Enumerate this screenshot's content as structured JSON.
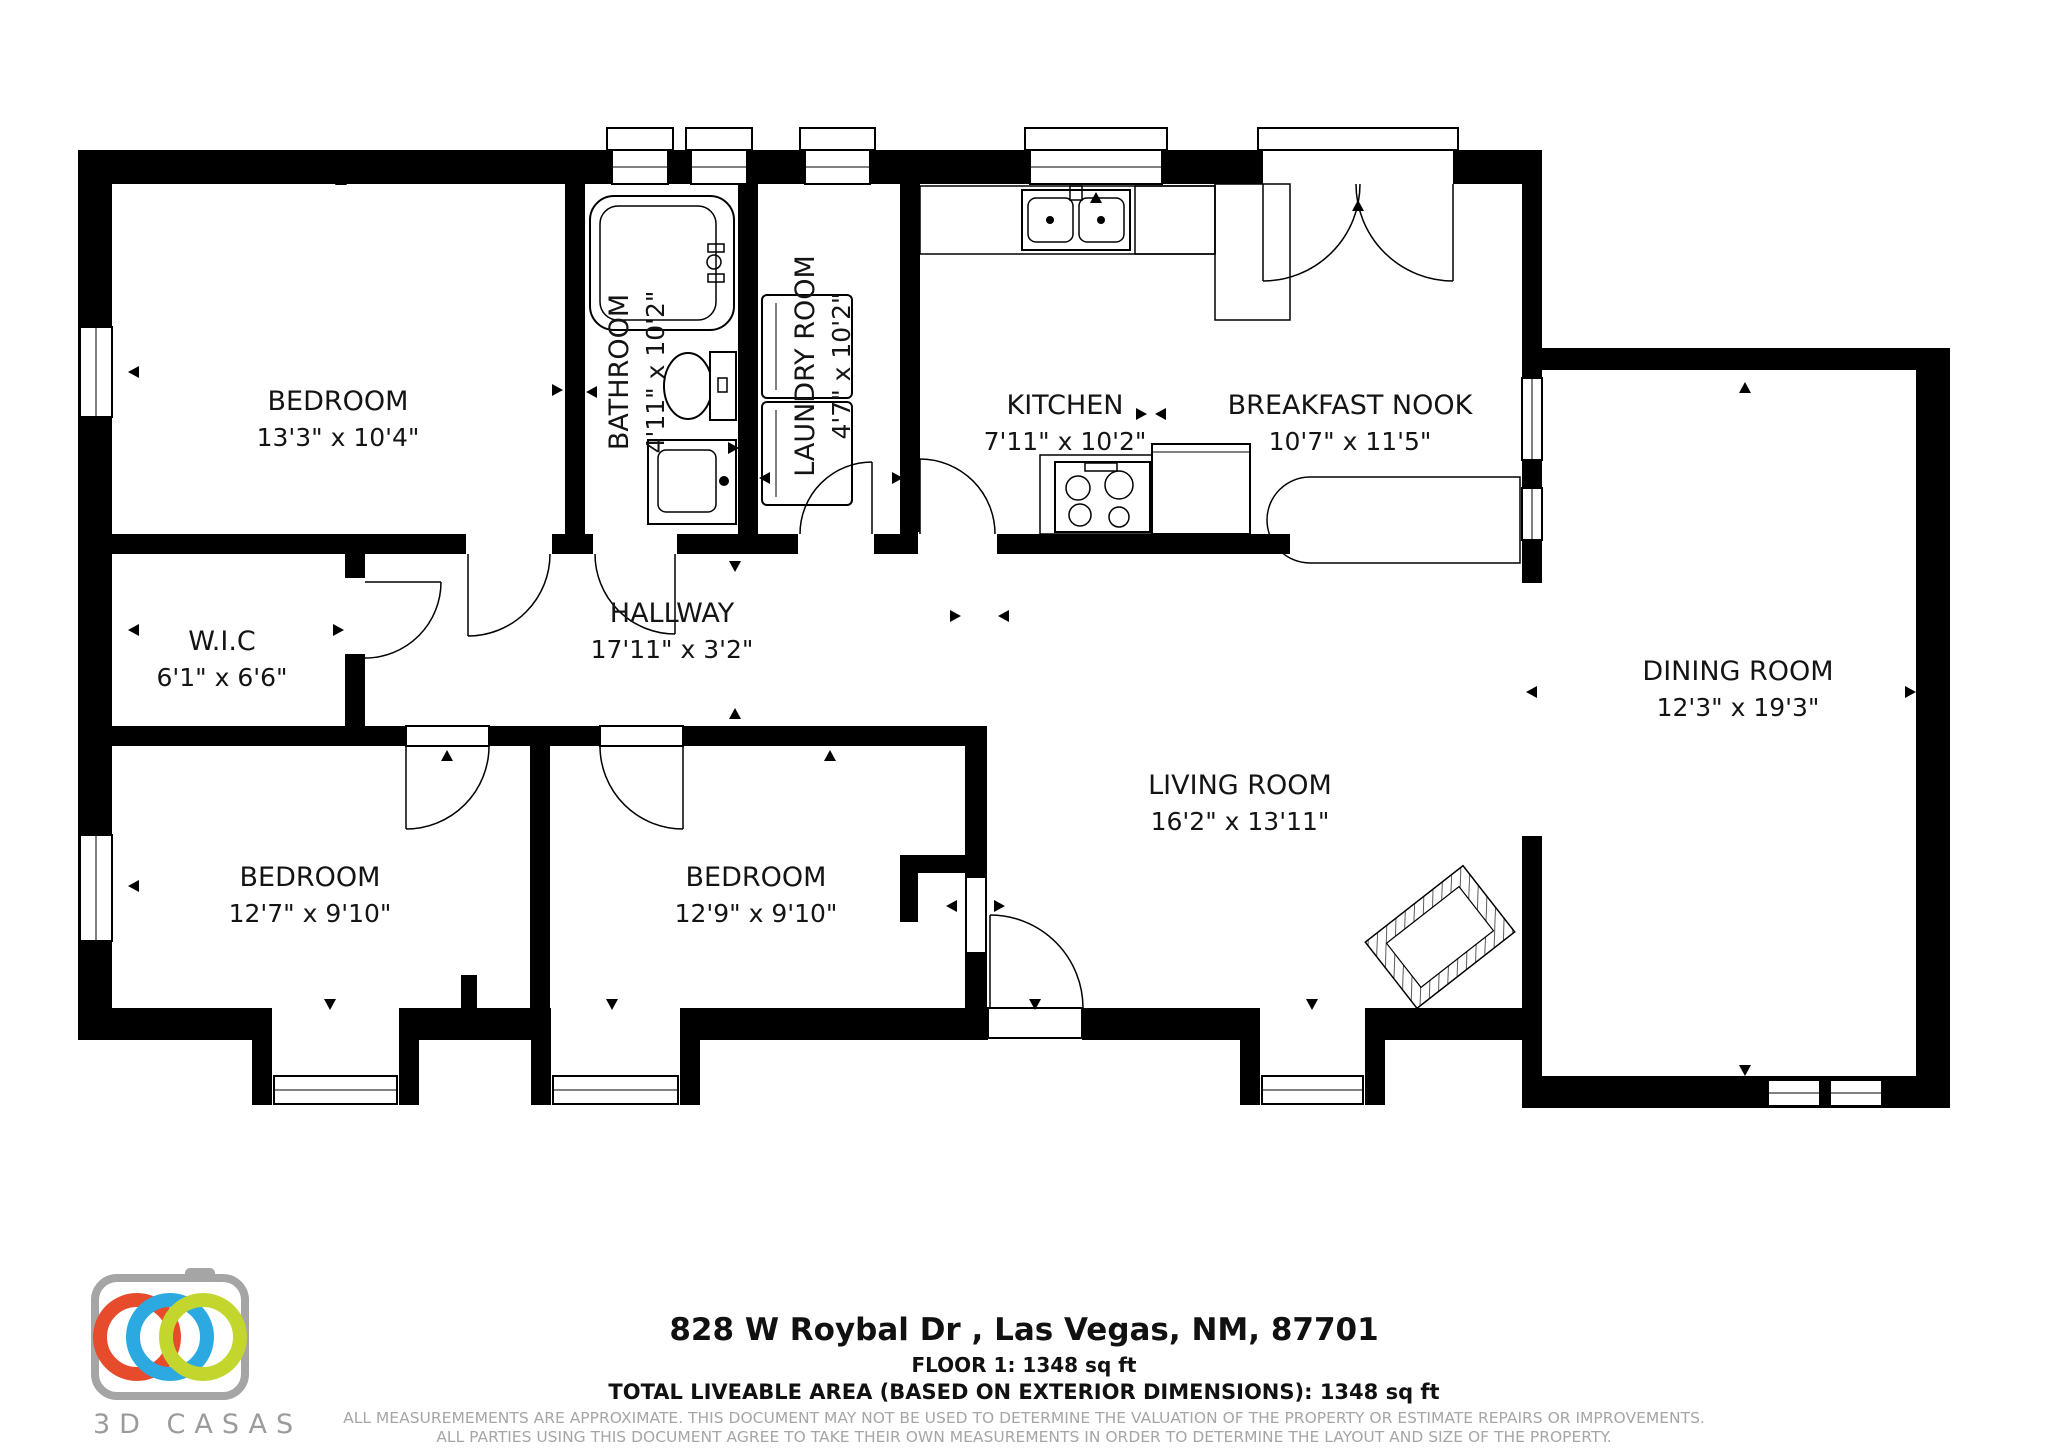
{
  "floorplan": {
    "rooms": [
      {
        "name": "BEDROOM",
        "dims": "13'3\" x 10'4\""
      },
      {
        "name": "BATHROOM",
        "dims": "4'11\" x 10'2\""
      },
      {
        "name": "LAUNDRY ROOM",
        "dims": "4'7\" x 10'2\""
      },
      {
        "name": "KITCHEN",
        "dims": "7'11\" x 10'2\""
      },
      {
        "name": "BREAKFAST NOOK",
        "dims": "10'7\" x 11'5\""
      },
      {
        "name": "W.I.C",
        "dims": "6'1\" x 6'6\""
      },
      {
        "name": "HALLWAY",
        "dims": "17'11\" x 3'2\""
      },
      {
        "name": "BEDROOM",
        "dims": "12'7\" x 9'10\""
      },
      {
        "name": "BEDROOM",
        "dims": "12'9\" x 9'10\""
      },
      {
        "name": "LIVING ROOM",
        "dims": "16'2\" x 13'11\""
      },
      {
        "name": "DINING ROOM",
        "dims": "12'3\" x 19'3\""
      }
    ]
  },
  "footer": {
    "address": "828 W Roybal Dr , Las Vegas, NM, 87701",
    "floor_line": "FLOOR 1: 1348 sq ft",
    "total_line": "TOTAL LIVEABLE AREA (BASED ON EXTERIOR DIMENSIONS): 1348 sq ft",
    "disclaimer1": "ALL MEASUREMEMENTS ARE APPROXIMATE. THIS DOCUMENT MAY NOT BE USED TO DETERMINE THE VALUATION OF THE PROPERTY OR ESTIMATE REPAIRS OR IMPROVEMENTS.",
    "disclaimer2": "ALL PARTIES USING THIS DOCUMENT AGREE TO TAKE THEIR OWN MEASUREMENTS IN ORDER TO DETERMINE THE LAYOUT AND SIZE OF THE PROPERTY."
  },
  "logo": {
    "brand": "3D CASAS",
    "colors": {
      "red": "#E64B2C",
      "blue": "#2BA9E0",
      "green": "#C3D62E",
      "gray": "#A5A5A5"
    }
  }
}
